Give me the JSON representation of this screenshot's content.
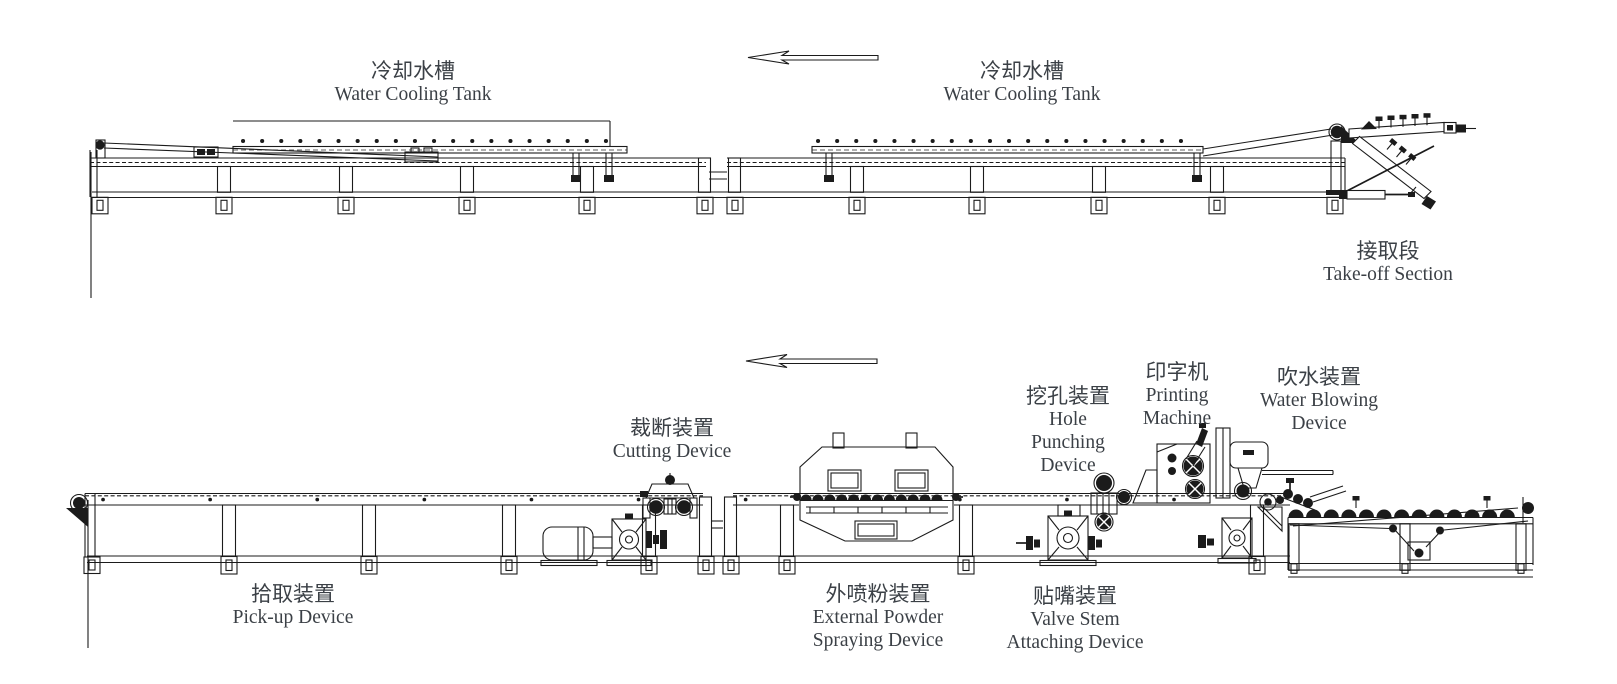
{
  "title": "Production line layout diagram",
  "colors": {
    "line": "#1b1b1b",
    "text": "#3b4046",
    "background": "#ffffff"
  },
  "arrows": {
    "top": {
      "icon": "left-arrow-icon",
      "direction": "left"
    },
    "bottom": {
      "icon": "left-arrow-icon",
      "direction": "left"
    }
  },
  "labels": {
    "cooling_tank_1": {
      "zh": "冷却水槽",
      "en": "Water Cooling Tank"
    },
    "cooling_tank_2": {
      "zh": "冷却水槽",
      "en": "Water Cooling Tank"
    },
    "take_off_section": {
      "zh": "接取段",
      "en": "Take-off Section"
    },
    "cutting_device": {
      "zh": "裁断装置",
      "en": "Cutting Device"
    },
    "hole_punching_device": {
      "zh": "挖孔装置",
      "en_lines": [
        "Hole",
        "Punching",
        "Device"
      ]
    },
    "printing_machine": {
      "zh": "印字机",
      "en_lines": [
        "Printing",
        "Machine"
      ]
    },
    "water_blowing_device": {
      "zh": "吹水装置",
      "en_lines": [
        "Water Blowing",
        "Device"
      ]
    },
    "pick_up_device": {
      "zh": "拾取装置",
      "en": "Pick-up Device"
    },
    "external_powder_spraying_device": {
      "zh": "外喷粉装置",
      "en_lines": [
        "External Powder",
        "Spraying Device"
      ]
    },
    "valve_stem_attaching_device": {
      "zh": "贴嘴装置",
      "en_lines": [
        "Valve Stem",
        "Attaching Device"
      ]
    }
  }
}
